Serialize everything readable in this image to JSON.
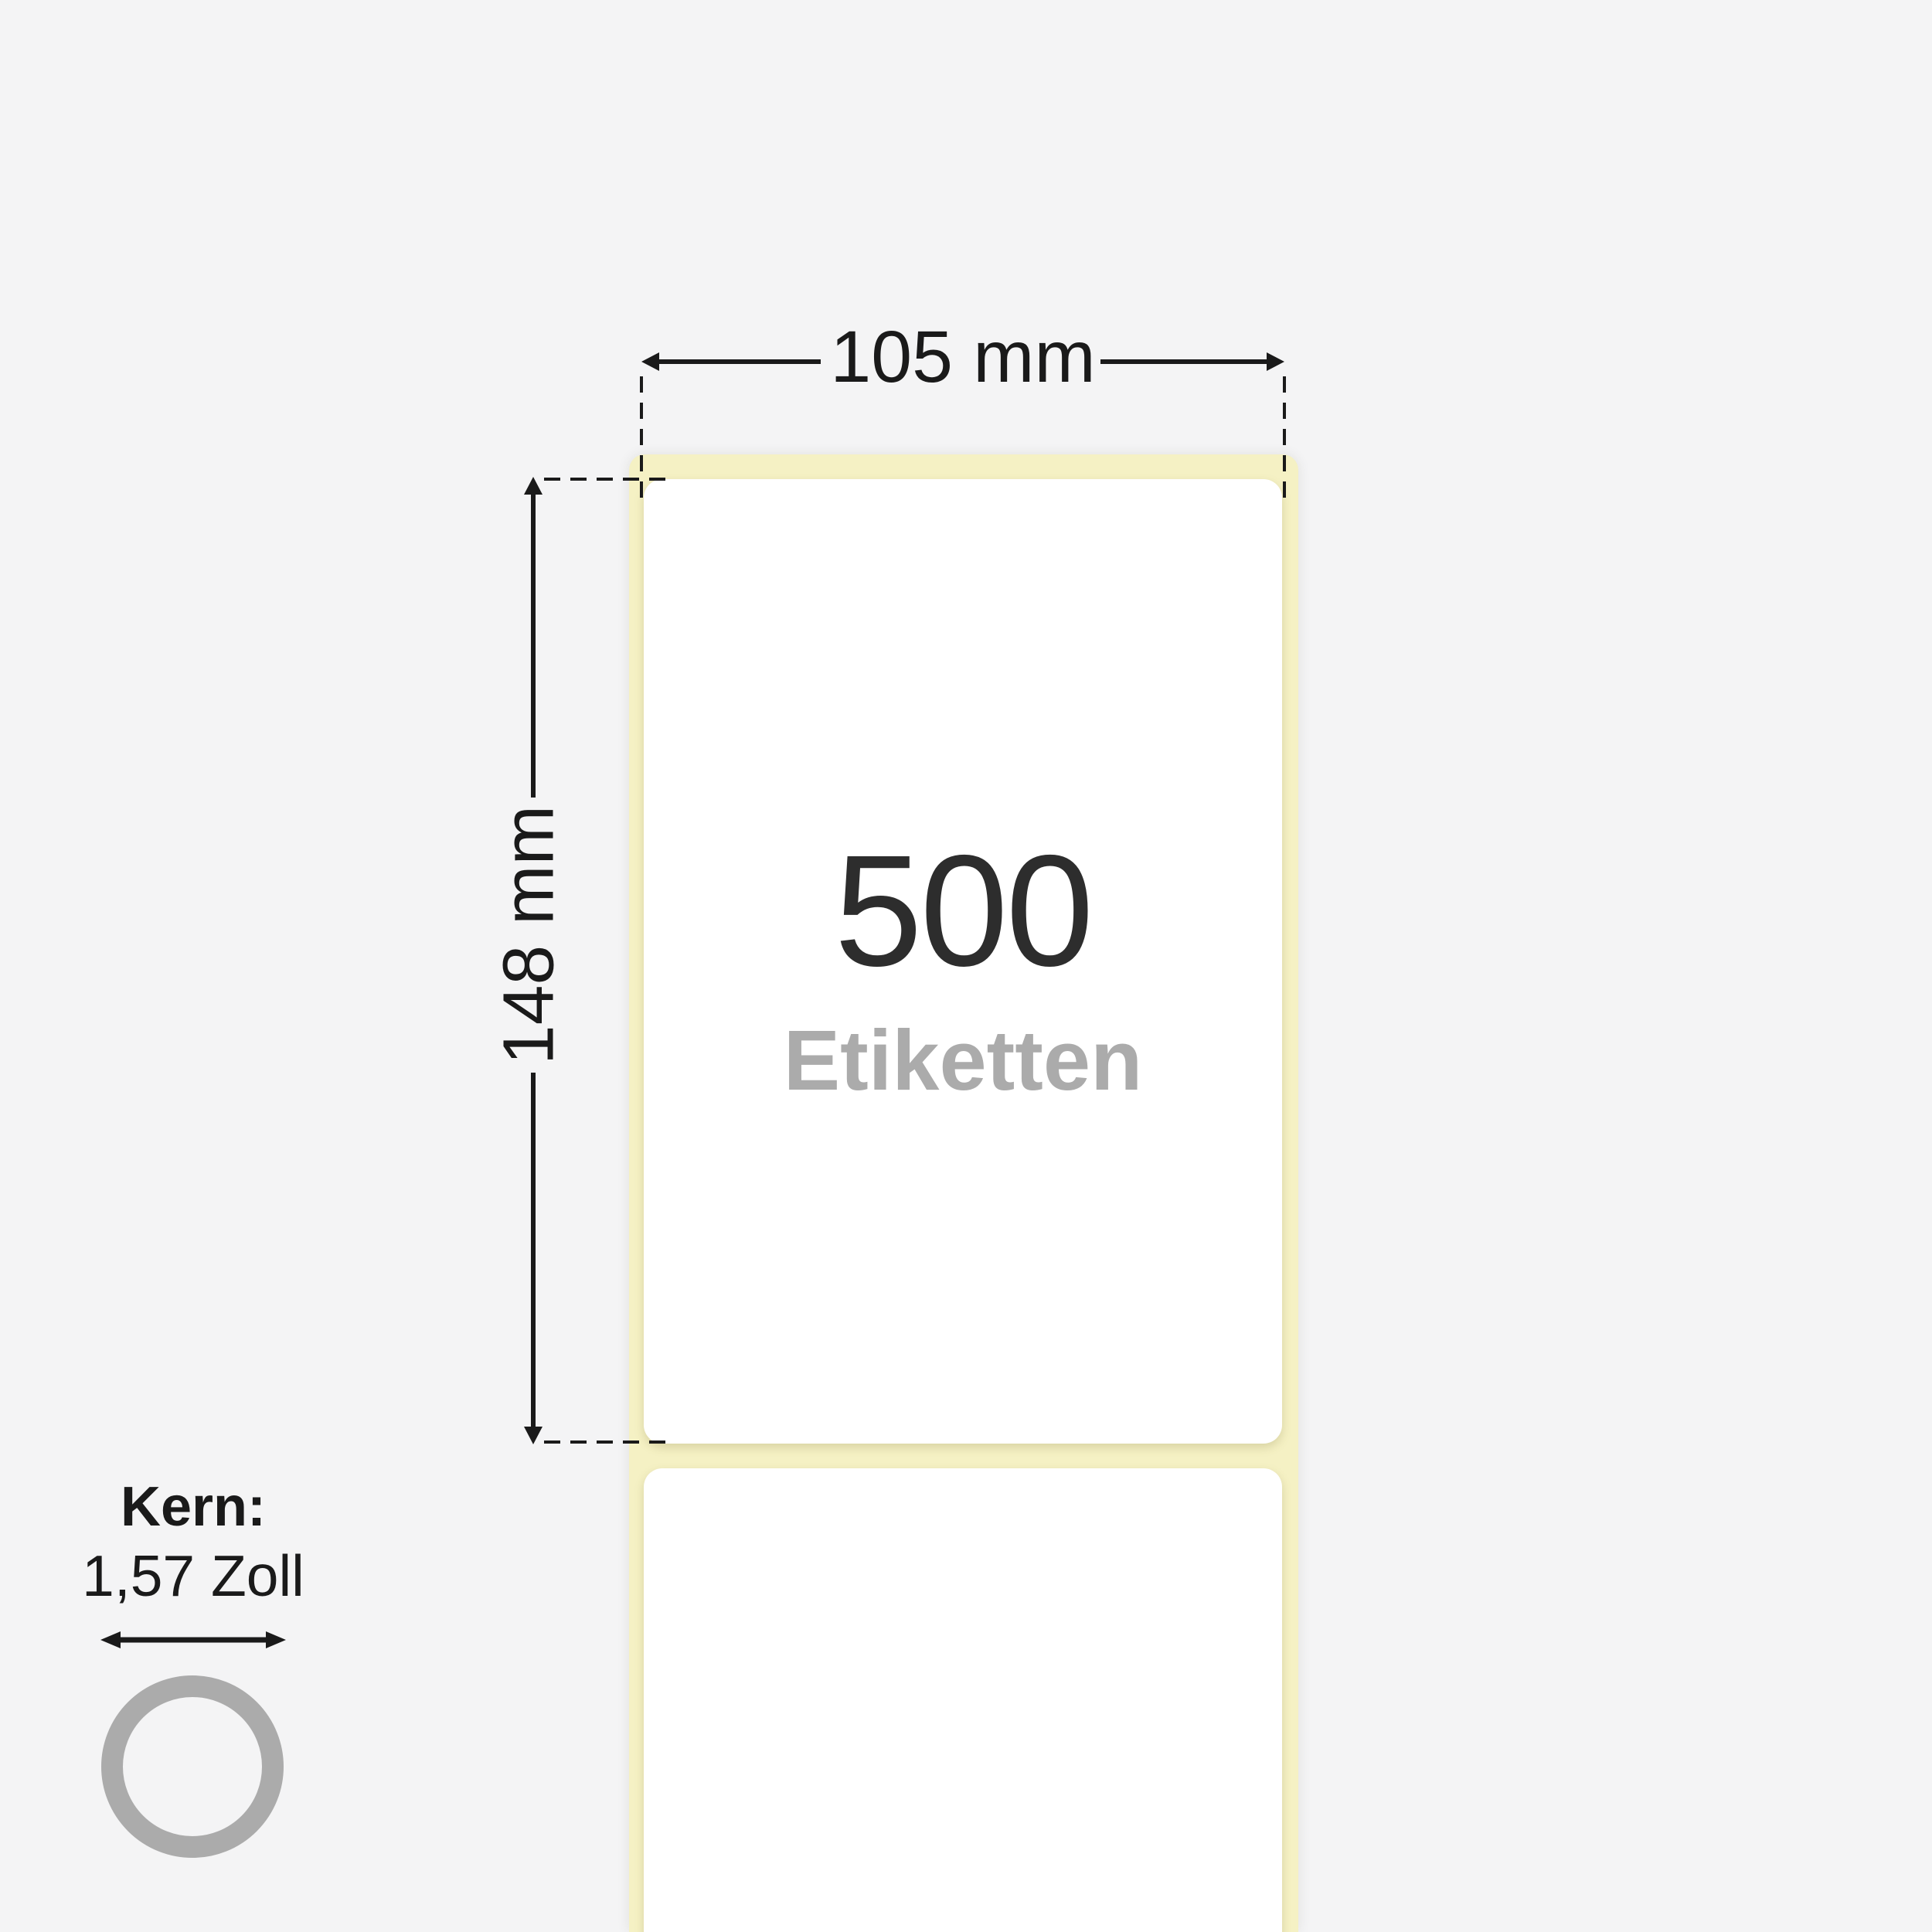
{
  "colors": {
    "background": "#f4f4f5",
    "liner": "#f5f1c4",
    "label": "#ffffff",
    "ink": "#1a1a1a",
    "count": "#2d2d2d",
    "muted": "#ababab"
  },
  "dimensions": {
    "width": {
      "label": "105 mm"
    },
    "height": {
      "label": "148 mm"
    }
  },
  "roll": {
    "count": "500",
    "unit": "Etiketten"
  },
  "core": {
    "title": "Kern:",
    "value": "1,57 Zoll",
    "icon": "core-ring-icon",
    "arrow_icon": "double-arrow-icon"
  }
}
